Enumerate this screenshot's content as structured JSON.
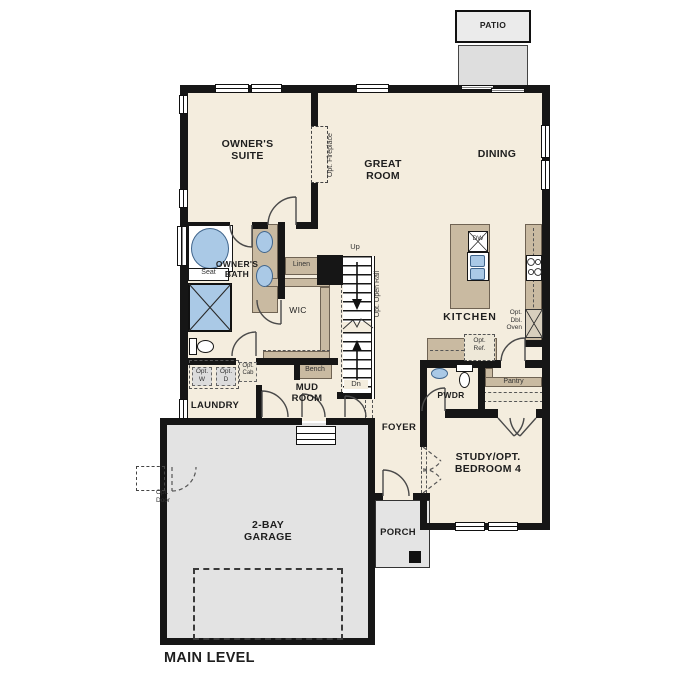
{
  "plan_title": "MAIN LEVEL",
  "rooms": {
    "owners_suite": "OWNER'S\nSUITE",
    "great_room": "GREAT\nROOM",
    "dining": "DINING",
    "kitchen": "KITCHEN",
    "owners_bath": "OWNER'S\nBATH",
    "wic": "WIC",
    "laundry": "LAUNDRY",
    "mud_room": "MUD\nROOM",
    "foyer": "FOYER",
    "powder": "PWDR",
    "study": "STUDY/OPT.\nBEDROOM 4",
    "garage": "2-BAY\nGARAGE",
    "porch": "PORCH",
    "patio": "PATIO"
  },
  "labels": {
    "up": "Up",
    "down": "Dn",
    "linen": "Linen",
    "seat": "Seat",
    "bench": "Bench",
    "pantry": "Pantry",
    "dishwasher": "DW",
    "opt_fireplace": "Opt. Fireplace",
    "opt_open_rail": "Opt. Open Rail",
    "opt_washer": "Opt.\nW",
    "opt_dryer": "Opt.\nD",
    "opt_cabinet": "Opt.\nCab",
    "opt_refrigerator": "Opt.\nRef.",
    "opt_double_oven": "Opt.\nDbl.\nOven",
    "opt_door": "Opt.\nDoor"
  },
  "colors": {
    "wall": "#161616",
    "floor": "#f4edde",
    "cabinetry": "#c9baa1",
    "fixture_blue": "#aac9e6",
    "concrete_gray": "#e3e3e3",
    "optional_dashed": "#555555"
  }
}
